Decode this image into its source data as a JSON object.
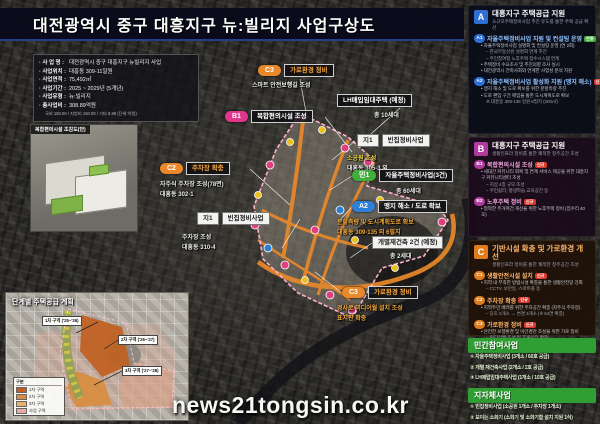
{
  "title": "대전광역시 중구 대흥지구 뉴:빌리지 사업구상도",
  "watermark": "news21tongsin.co.kr",
  "colors": {
    "accent_orange": "#e8882a",
    "accent_pink": "#e0368c",
    "accent_green": "#3fae3a",
    "accent_blue": "#2f7fd8",
    "section_a": "#2e6fd6",
    "section_b": "#b13aa0",
    "section_c": "#e07c1e",
    "header_green": "#2f9e33"
  },
  "project_info": {
    "rows": [
      {
        "label": "사 업 명",
        "value": "대전광역시 중구 대흥지구 뉴빌리지 사업"
      },
      {
        "label": "사업위치",
        "value": "대흥동 309-11일원"
      },
      {
        "label": "사업면적",
        "value": "75,492㎡"
      },
      {
        "label": "사업기간",
        "value": "2025 ~ 2029년 (5개년)"
      },
      {
        "label": "사업유형",
        "value": "뉴:빌리지"
      },
      {
        "label": "총사업비",
        "value": "308.89억원"
      }
    ],
    "note": "국비 150.00 / 지방비 150.00 / 기타 8.89 (단위:억원)"
  },
  "render_caption": "복합편의시설 조감도(안)",
  "map": {
    "c3top": {
      "badge": "C3",
      "title": "가로환경 정비",
      "l1": "스마트 안전보행길 조성"
    },
    "b1": {
      "badge": "B1",
      "title": "복합편의시설 조성"
    },
    "c2": {
      "badge": "C2",
      "title": "주차장 확충",
      "l1": "자주식 주차장 조성(78면)",
      "l2": "대흥동 302-1"
    },
    "ji1": {
      "badge": "지1",
      "title": "빈집정비사업",
      "l1": "주차장 조성",
      "l2": "대흥동 310-4"
    },
    "lh": {
      "title": "LH매입임대주택 (예정)",
      "l1": "총 10세대"
    },
    "ji2": {
      "badge": "지1",
      "title": "빈집정비사업",
      "l1": "소공원 조성",
      "l2": "대흥동 305-3 외"
    },
    "min1": {
      "badge": "민1",
      "title": "자율주택정비사업(3건)",
      "l1": "총 60세대"
    },
    "a2": {
      "badge": "A2",
      "title": "맹지 해소 / 도로 확보",
      "l1": "분할측량 및 도시계획도로 확보",
      "l2": "대흥동 309-135 외 6필지"
    },
    "rebuild": {
      "title": "개별재건축 2건 (예정)",
      "l1": "총 2세대"
    },
    "c3bot": {
      "badge": "C3",
      "title": "가로환경 정비",
      "l1": "경사로 미디어월 설치 조성",
      "l2": "표지판 확충"
    }
  },
  "sidebar": {
    "a": {
      "letter": "A",
      "title": "대흥지구 주택공급 지원",
      "subtitle": "소규모주택정비사업 추진 유도를 통한 주택 공급 확산",
      "items": [
        {
          "code": "A1",
          "title": "자율주택정비사업 지원 및 컨설팅 운영",
          "tag": "연중",
          "bullets": [
            "• 자율주택정비사업 설명회 및 컨설팅 운영 (연 2회)",
            "– 한국부동산원 설명회 연계 추진",
            "– 주민참여형 노후주택 접수시스템 연계",
            "• 주택정비 수요조사 및 추진의향 조사 실시",
            "• 대전광역시 건축사회와 연계한 사업성 분석 지원"
          ]
        },
        {
          "code": "A2",
          "title": "자율주택정비사업 활성화 지원 (맹지 해소)",
          "tag": "신규",
          "bullets": [
            "• 맹지 해소 및 도로 확보를 위한 분할측량 추진",
            "• 도로 편입 구간 매입을 통한 도시계획도로 확보",
            "※ 대흥동 309-135 일원 6필지 (300㎡)"
          ]
        }
      ]
    },
    "b": {
      "letter": "B",
      "title": "대흥지구 주택공급 지원",
      "subtitle": "생활인프라 정비를 통한 쾌적한 정주공간 조성",
      "items": [
        {
          "code": "B1",
          "title": "복합편의시설 조성",
          "tag": "신규",
          "bullets": [
            "• 세대간 커뮤니티 회복 및 연계 서비스 제공을 위한 대흥지구 커뮤니티센터 조성",
            "– 지상 4층 규모 조성",
            "– 주민쉼터, 평생학습·교육공간 등"
          ]
        },
        {
          "code": "B2",
          "title": "노후주택 정비",
          "tag": "신규",
          "bullets": [
            "• 열악한 주거여건 개선을 위한 노후주택 정비 (집수리 40호)"
          ]
        }
      ]
    },
    "c": {
      "letter": "C",
      "title": "기반시설 확충 및 가로환경 개선",
      "subtitle": "생활인프라 정비를 통한 쾌적한 정주공간 조성",
      "items": [
        {
          "code": "C1",
          "title": "생활안전시설 설치",
          "tag": "신규",
          "bullets": [
            "• 지역 내 부족한 방범시설 확충을 통한 생활안전망 강화",
            "– CCTV, 보안등, 스마트폴 등"
          ]
        },
        {
          "code": "C2",
          "title": "주차장 확충",
          "tag": "신규",
          "bullets": [
            "• 지역주민 배려를 위한 주차공간 확충 (자주식 주차장)",
            "– 당초 2개소 → 변경 3개소 (※ 54면 확충)"
          ]
        },
        {
          "code": "C3",
          "title": "가로환경 정비",
          "tag": "신규",
          "bullets": [
            "• 안전한 보행환경 및 야간경관 조성을 위한 가로 정비",
            "– 미디어월 조성 및 휴게쉼터 확충",
            "– 스마트 안전 보행환경 조성"
          ]
        }
      ]
    },
    "private": {
      "header": "민간참여사업",
      "items": [
        "① 자율주택정비사업 (3개소 / 60호 공급)",
        "② 개별 재건축사업 (2개소 / 2호 공급)",
        "③ LH매입임대주택사업 (1개소 / 10호 공급)"
      ]
    },
    "municipal": {
      "header": "지자체사업",
      "items": [
        "① 빈집정비사업 (소공원 1개소 / 주차장 1개소)",
        "② 보이는 소화기 (소화기 및 소화기함 설치 지원 1식)"
      ]
    }
  },
  "phase": {
    "title": "단계별 주택공급 계획",
    "legend_header": "구분",
    "legend": [
      {
        "label": "1차 구역",
        "color": "#c06020"
      },
      {
        "label": "2차 구역",
        "color": "#d98c3f"
      },
      {
        "label": "3차 구역",
        "color": "#e8b268"
      },
      {
        "label": "사업 구역",
        "color": "#e3aba5"
      }
    ],
    "callouts": [
      "1차 구역 ('25~'26)",
      "2차 구역 ('26~'27)",
      "3차 구역 ('27~'28)"
    ]
  }
}
